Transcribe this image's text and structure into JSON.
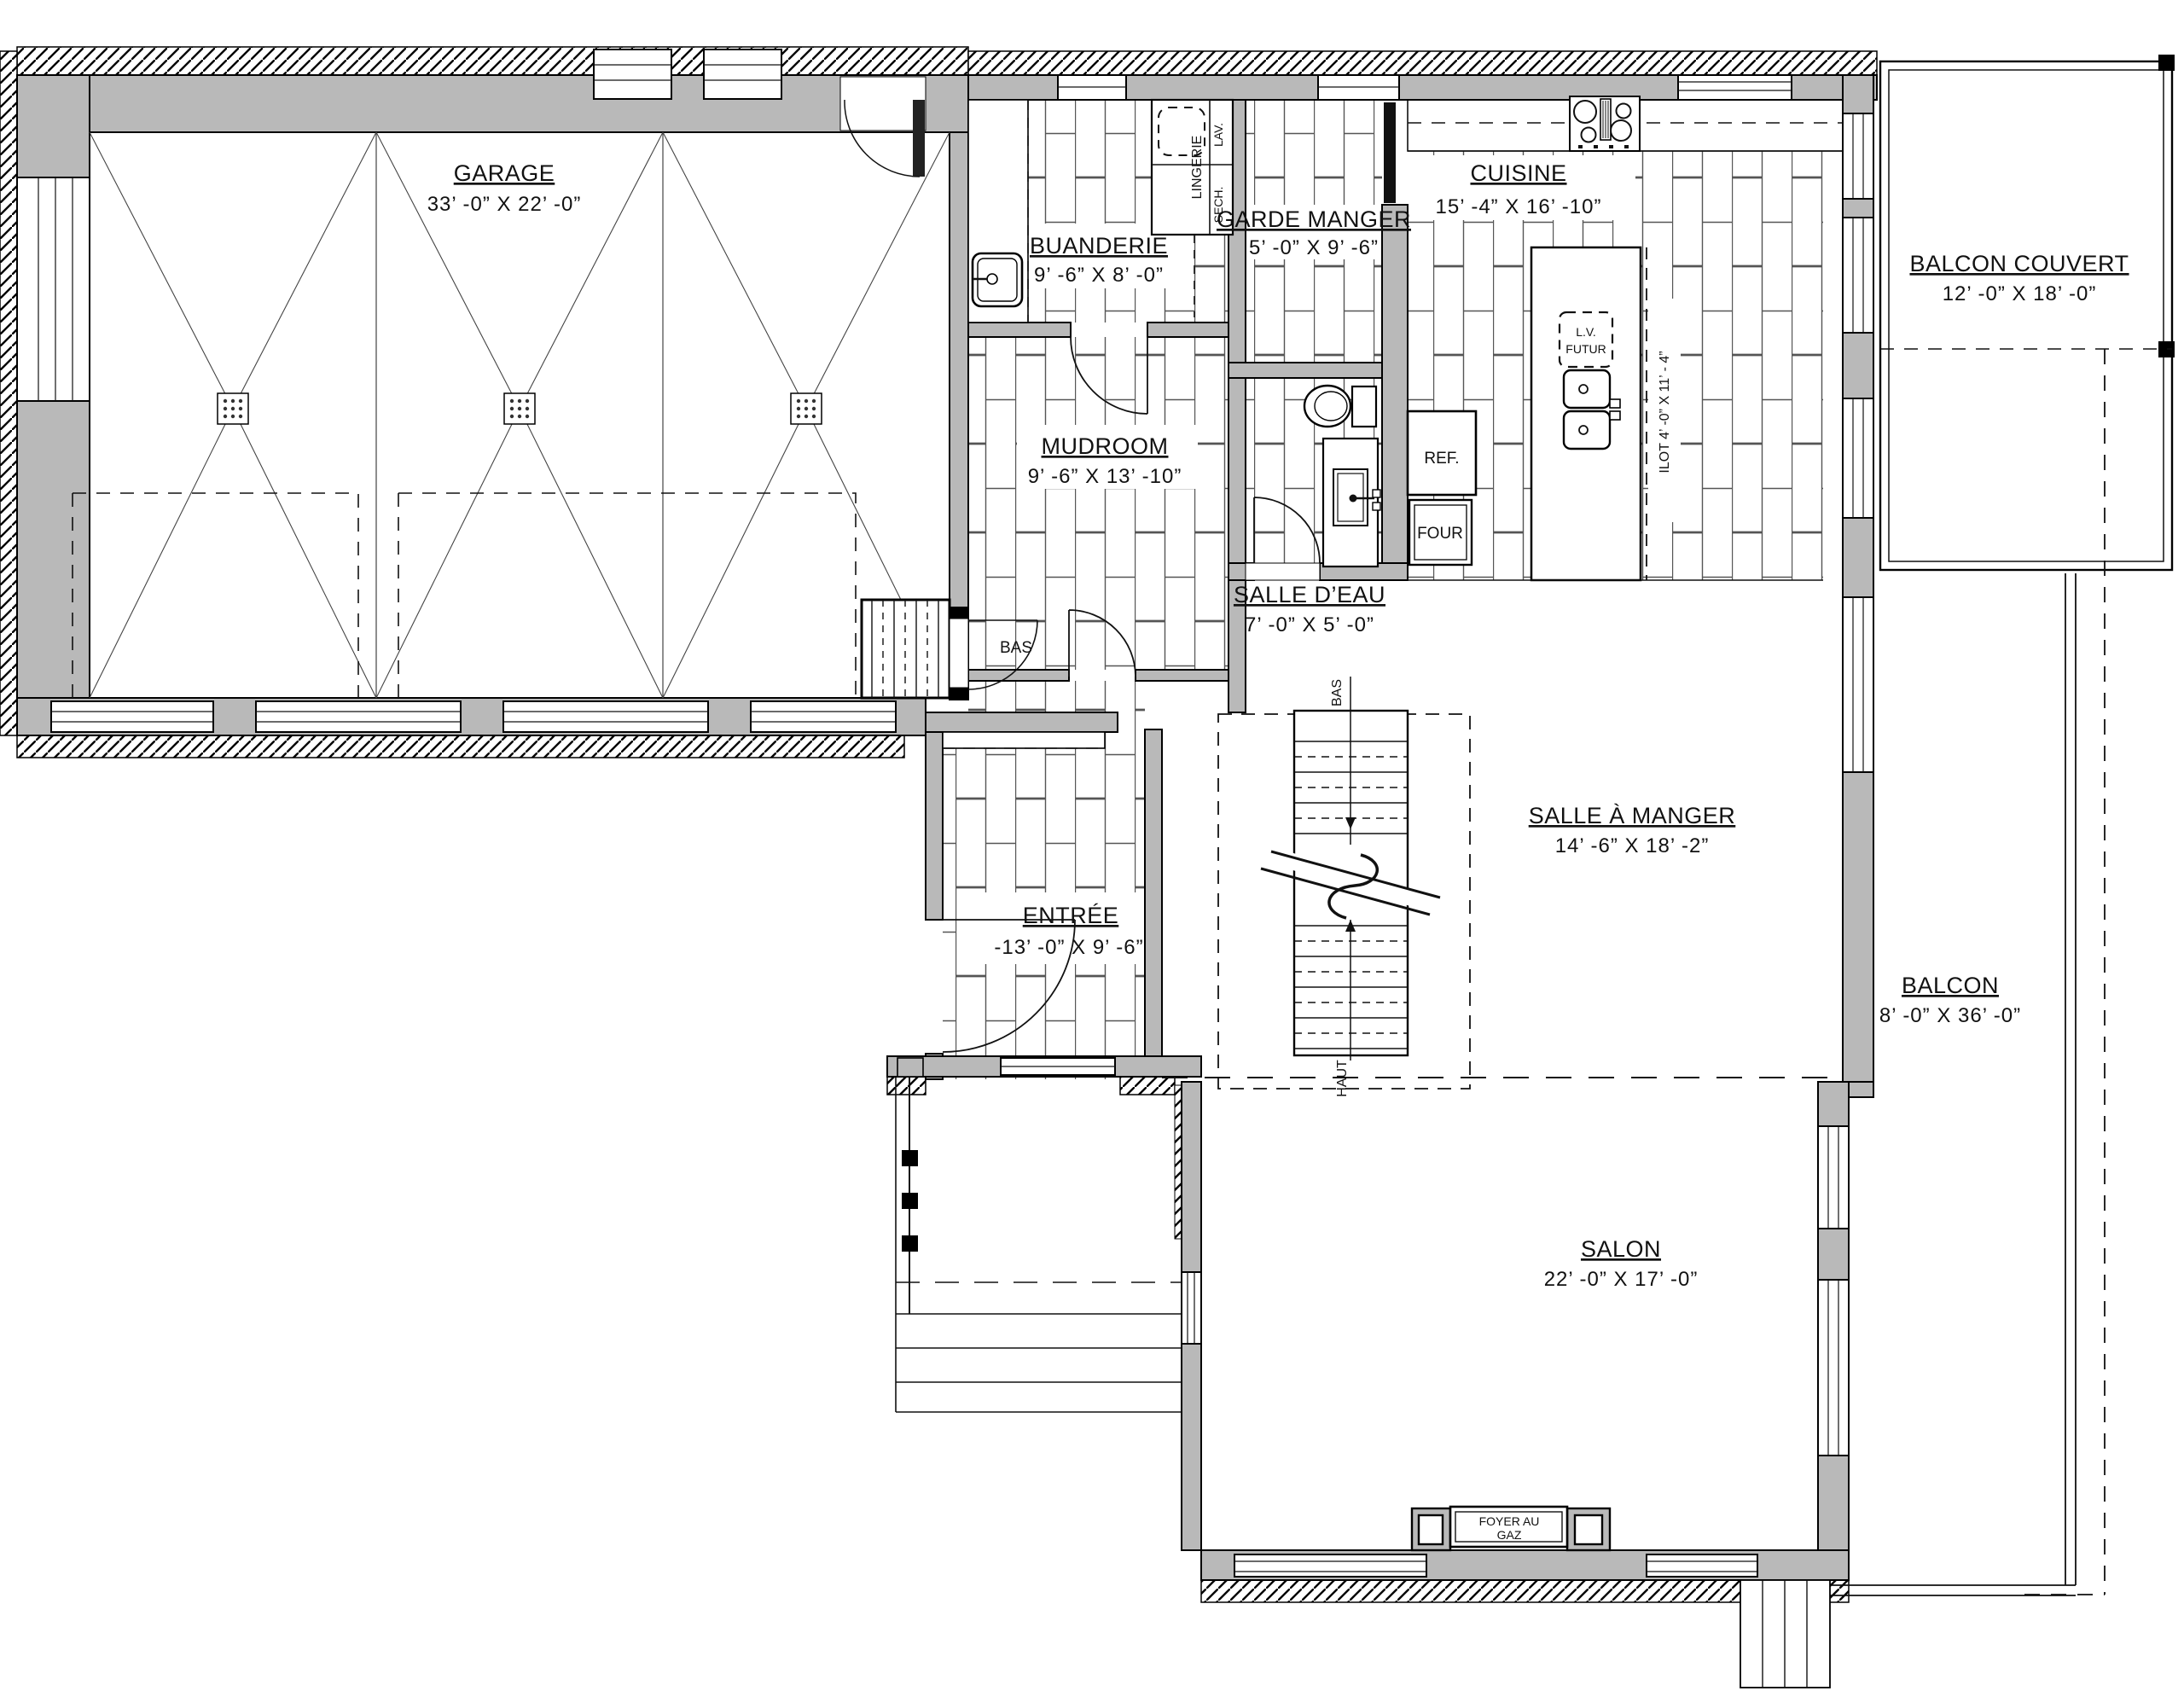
{
  "plan_title": "Floor plan – rez-de-chaussée",
  "rooms": {
    "garage": {
      "name": "GARAGE",
      "dims": "33’ -0”  X  22’ -0”"
    },
    "buanderie": {
      "name": "BUANDERIE",
      "dims": "9’ -6”  X  8’ -0”"
    },
    "garde_manger": {
      "name": "GARDE MANGER",
      "dims": "5’ -0”  X  9’ -6”"
    },
    "cuisine": {
      "name": "CUISINE",
      "dims": "15’ -4”  X  16’ -10”"
    },
    "balcon_couvert": {
      "name": "BALCON COUVERT",
      "dims": "12’ -0”  X  18’ -0”"
    },
    "mudroom": {
      "name": "MUDROOM",
      "dims": "9’ -6”  X  13’ -10”"
    },
    "salle_deau": {
      "name": "SALLE D’EAU",
      "dims": "7’ -0”  X  5’ -0”"
    },
    "salle_a_manger": {
      "name": "SALLE À MANGER",
      "dims": "14’ -6”  X  18’ -2”"
    },
    "balcon": {
      "name": "BALCON",
      "dims": "8’ -0”  X  36’ -0”"
    },
    "entree": {
      "name": "ENTRÉE",
      "dims": "-13’ -0”  X  9’ -6”"
    },
    "salon": {
      "name": "SALON",
      "dims": "22’ -0”  X  17’ -0”"
    }
  },
  "labels": {
    "ref": "REF.",
    "four": "FOUR",
    "lingerie": "LINGERIE",
    "lav": "LAV.",
    "sech": "SECH.",
    "lv": "L.V.",
    "lv_futur": "FUTUR",
    "ilot": "ILOT 4’ -0” X 11’ - 4”",
    "bas_stair_garage": "BAS",
    "bas": "BAS",
    "haut": "HAUT",
    "foyer_1": "FOYER AU",
    "foyer_2": "GAZ"
  }
}
